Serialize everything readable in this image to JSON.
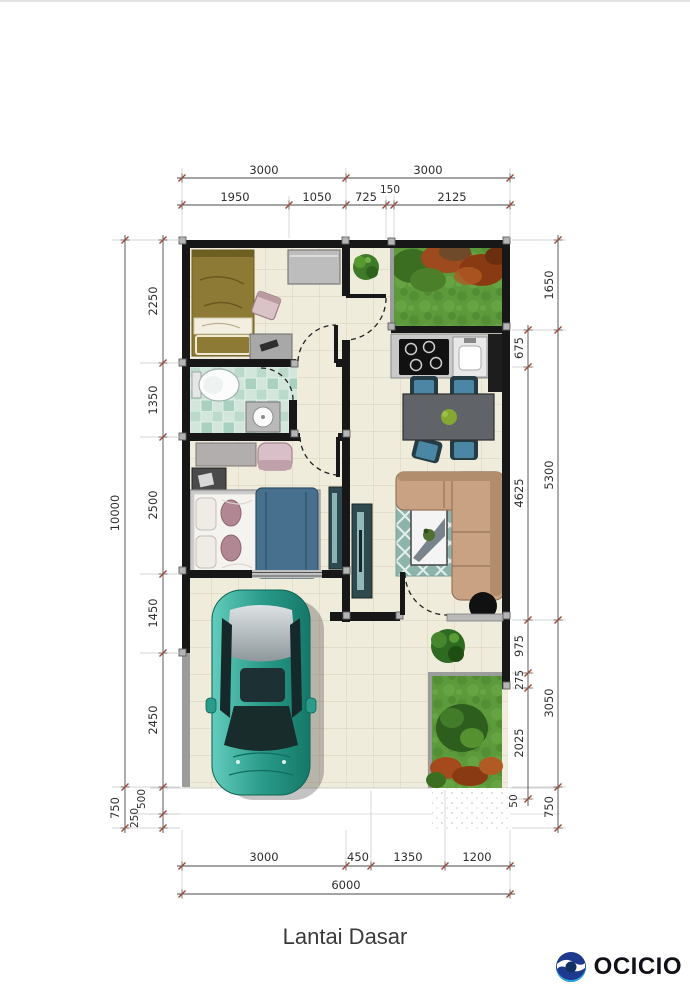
{
  "title": "Lantai Dasar",
  "logo": {
    "brand": "OCICIO"
  },
  "colors": {
    "wall": "#171717",
    "floor_tile": "#efecdb",
    "bath_tile": "#c4ded2",
    "grass": "#5d9a3c",
    "car": "#2b9c8b",
    "sofa": "#c9a284",
    "rug": "#8db4ab",
    "logo_navy": "#1d3a8f",
    "logo_blue": "#2aa6e0"
  },
  "dims": {
    "top_outer": [
      "3000",
      "3000"
    ],
    "top_inner": [
      "1950",
      "1050",
      "725",
      "150",
      "2125"
    ],
    "bottom_inner": [
      "3000",
      "450",
      "1350",
      "1200"
    ],
    "bottom_outer": [
      "6000"
    ],
    "left_outer": [
      "10000",
      "750"
    ],
    "left_inner": [
      "2250",
      "1350",
      "2500",
      "1450",
      "2450",
      "500",
      "250"
    ],
    "right_inner": [
      "675",
      "4625",
      "975",
      "275",
      "2025",
      "50"
    ],
    "right_outer": [
      "1650",
      "5300",
      "3050",
      "750"
    ]
  }
}
